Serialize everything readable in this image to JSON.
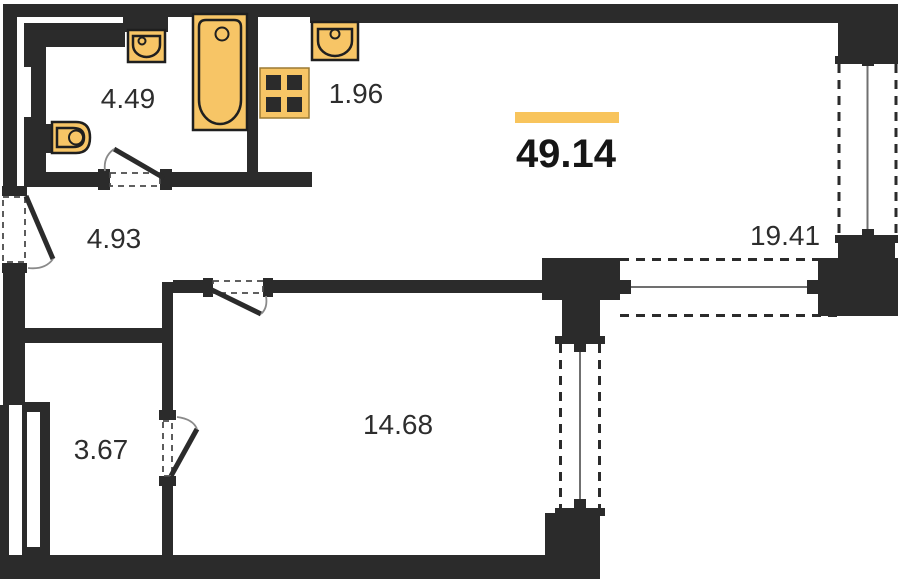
{
  "plan": {
    "title": "apartment-floor-plan",
    "total": {
      "area": "49.14"
    },
    "rooms": [
      {
        "id": "bathroom",
        "area": "4.49"
      },
      {
        "id": "kitchen-niche",
        "area": "1.96"
      },
      {
        "id": "hallway",
        "area": "4.93"
      },
      {
        "id": "storage",
        "area": "3.67"
      },
      {
        "id": "bedroom",
        "area": "14.68"
      },
      {
        "id": "living-room",
        "area": "19.41"
      }
    ],
    "fixtures": [
      "bathtub",
      "bathroom-sink",
      "kitchen-sink",
      "stove-4-burner",
      "toilet"
    ],
    "features": [
      "entrance-door",
      "bathroom-door",
      "bedroom-door",
      "storage-door",
      "window-right",
      "window-living-south",
      "window-bedroom-east"
    ],
    "colors": {
      "wall": "#2b2b2b",
      "fixture": "#F7C566",
      "fixtureOutline": "#1f1f1f",
      "accent": "#F8C45C",
      "text": "#2d2d2d",
      "textStrong": "#161616",
      "dash": "#4a4a4a",
      "centerline": "#707070",
      "arc": "#8a8a8a",
      "background": "#ffffff"
    }
  }
}
